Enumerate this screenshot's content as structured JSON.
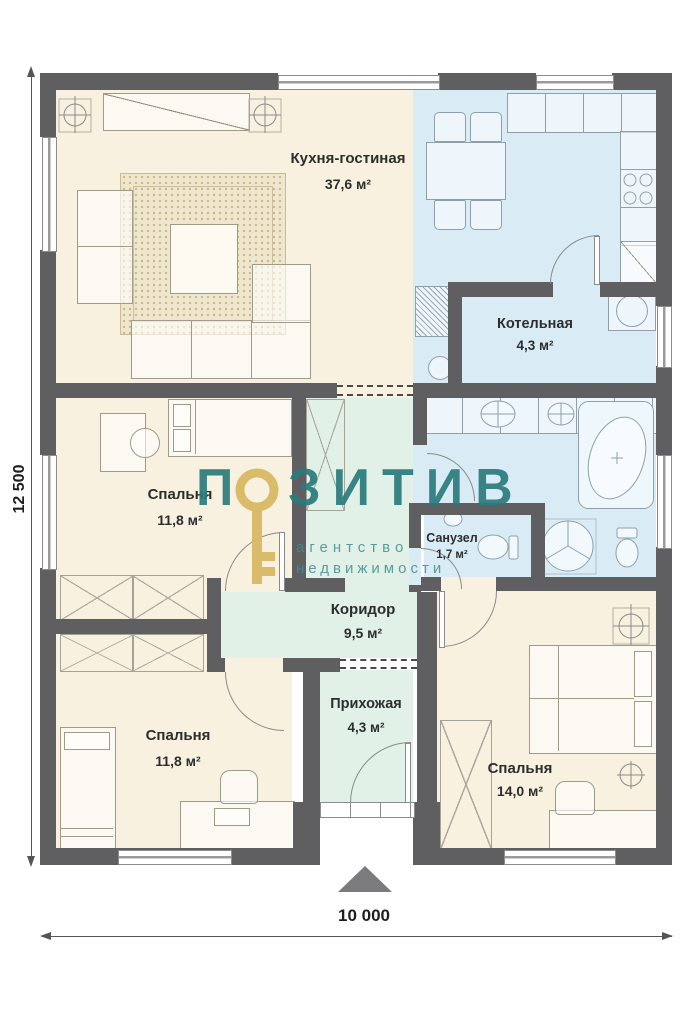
{
  "plan": {
    "rooms": [
      {
        "name": "Кухня-гостиная",
        "area": "37,6 м²"
      },
      {
        "name": "Котельная",
        "area": "4,3 м²"
      },
      {
        "name": "Спальня",
        "area": "11,8 м²"
      },
      {
        "name": "Санузел",
        "area": "1,7 м²"
      },
      {
        "name": "Коридор",
        "area": "9,5 м²"
      },
      {
        "name": "Прихожая",
        "area": "4,3 м²"
      },
      {
        "name": "Спальня",
        "area": "11,8 м²"
      },
      {
        "name": "Спальня",
        "area": "14,0 м²"
      }
    ],
    "dimensions": {
      "vertical": "12 500",
      "horizontal": "10 000"
    }
  },
  "watermark": {
    "brand_first_letter": "П",
    "brand_rest": "ЗИТИВ",
    "tagline_line1": "агентство",
    "tagline_line2": "недвижимости",
    "brand_color": "#2a7b7d",
    "key_color": "#d9b963"
  },
  "colors": {
    "wall": "#5f5f61",
    "floor_living": "#f8f1e0",
    "floor_wet": "#d9ecf6",
    "floor_hall": "#e1f1e7"
  }
}
